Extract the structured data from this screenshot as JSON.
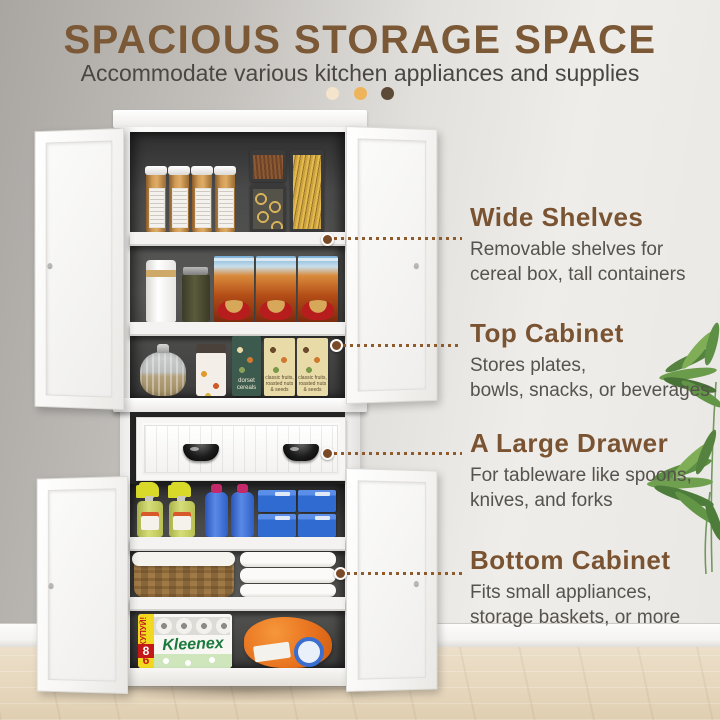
{
  "header": {
    "title": "SPACIOUS STORAGE SPACE",
    "subtitle": "Accommodate various kitchen appliances and supplies"
  },
  "callouts": {
    "wide_shelves": {
      "title": "Wide Shelves",
      "line1": "Removable shelves for",
      "line2": "cereal box, tall containers"
    },
    "top_cabinet": {
      "title": "Top Cabinet",
      "line1": "Stores plates,",
      "line2": "bowls, snacks, or beverages"
    },
    "large_drawer": {
      "title": "A Large Drawer",
      "line1": "For tableware like spoons,",
      "line2": "knives, and forks"
    },
    "bottom_cabinet": {
      "title": "Bottom Cabinet",
      "line1": "Fits small appliances,",
      "line2": "storage baskets, or more"
    }
  },
  "products": {
    "cereal_brand": "dorset cereals",
    "cereal_variant": "classic fruits, roasted nuts & seeds",
    "tissue_brand": "Kleenex",
    "tissue_promo": "КУПУЙ!",
    "tissue_promo_big": "8",
    "tissue_promo_small": "6"
  },
  "colors": {
    "accent_brown": "#7b5836",
    "text_gray": "#56524c",
    "dot_light": "#f3e4cb",
    "dot_amber": "#edb45c",
    "dot_dark": "#5c4a36",
    "marker_brown": "#7a4a26"
  }
}
